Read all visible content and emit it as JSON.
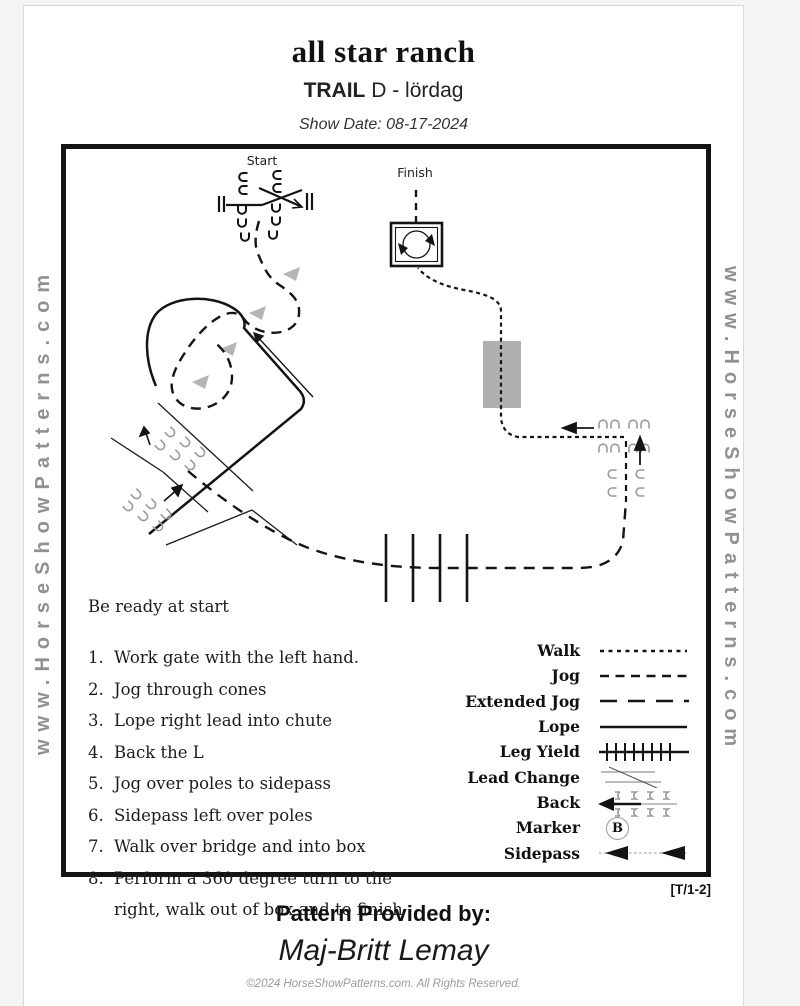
{
  "header": {
    "title": "all star ranch",
    "event_type": "TRAIL",
    "event_detail": "D - lördag",
    "show_date": "Show Date: 08-17-2024"
  },
  "watermark": {
    "left": "www.HorseShowPatterns.com",
    "right": "www.HorseShowPatterns.com"
  },
  "diagram": {
    "start_label": "Start",
    "finish_label": "Finish"
  },
  "instructions": {
    "intro": "Be ready at start",
    "items": [
      {
        "num": "1.",
        "text": "Work gate with the left hand."
      },
      {
        "num": "2.",
        "text": "Jog through cones"
      },
      {
        "num": "3.",
        "text": "Lope right lead into chute"
      },
      {
        "num": "4.",
        "text": "Back the L"
      },
      {
        "num": "5.",
        "text": "Jog over poles to sidepass"
      },
      {
        "num": "6.",
        "text": "Sidepass left over poles"
      },
      {
        "num": "7.",
        "text": "Walk over bridge and into box"
      },
      {
        "num": "8.",
        "text": "Perform a 360 degree turn to the right, walk out of box and to finish"
      }
    ]
  },
  "legend": {
    "marker_letter": "B",
    "rows": [
      {
        "label": "Walk"
      },
      {
        "label": "Jog"
      },
      {
        "label": "Extended Jog"
      },
      {
        "label": "Lope"
      },
      {
        "label": "Leg Yield"
      },
      {
        "label": "Lead Change"
      },
      {
        "label": "Back"
      },
      {
        "label": "Marker"
      },
      {
        "label": "Sidepass"
      }
    ]
  },
  "footer": {
    "pattern_ref": "[T/1-2]",
    "provided_by": "Pattern Provided by:",
    "provider_name": "Maj-Britt Lemay",
    "copyright": "©2024 HorseShowPatterns.com. All Rights Reserved."
  },
  "colors": {
    "watermark_gray": "#919191",
    "obstacle_gray": "#9a9a9a",
    "cone_gray": "#b5b5b5",
    "bridge_gray": "#b0b0b0",
    "line_black": "#141414"
  }
}
